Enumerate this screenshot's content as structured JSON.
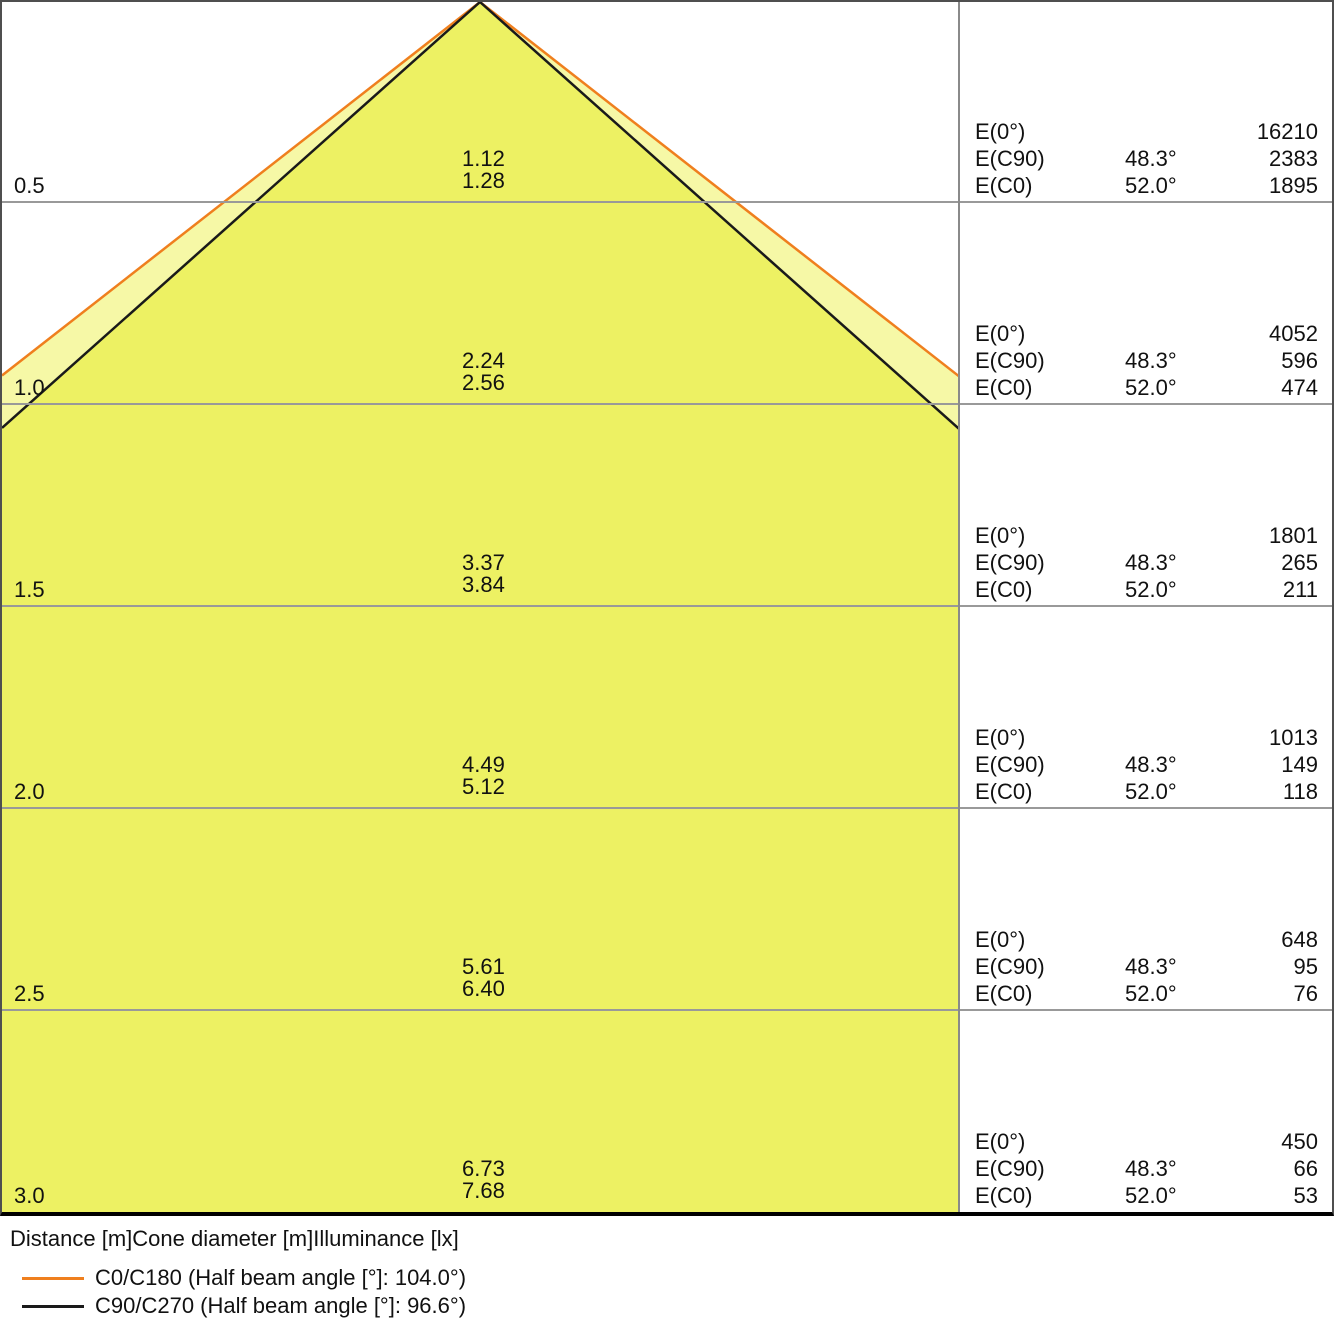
{
  "colors": {
    "cone_outer_fill": "#F6F8A6",
    "cone_inner_fill": "#EDF163",
    "c0_line": "#EF7F1E",
    "c90_line": "#1A1A1A",
    "grid_line": "#999999",
    "frame": "#4F4F4F"
  },
  "panel": {
    "e0_label": "E(0°)",
    "ec90_label": "E(C90)",
    "ec0_label": "E(C0)"
  },
  "rows": [
    {
      "distance": "0.5",
      "cone_c90": "1.12",
      "cone_c0": "1.28",
      "e0": "16210",
      "ec90_angle": "48.3°",
      "ec90": "2383",
      "ec0_angle": "52.0°",
      "ec0": "1895"
    },
    {
      "distance": "1.0",
      "cone_c90": "2.24",
      "cone_c0": "2.56",
      "e0": "4052",
      "ec90_angle": "48.3°",
      "ec90": "596",
      "ec0_angle": "52.0°",
      "ec0": "474"
    },
    {
      "distance": "1.5",
      "cone_c90": "3.37",
      "cone_c0": "3.84",
      "e0": "1801",
      "ec90_angle": "48.3°",
      "ec90": "265",
      "ec0_angle": "52.0°",
      "ec0": "211"
    },
    {
      "distance": "2.0",
      "cone_c90": "4.49",
      "cone_c0": "5.12",
      "e0": "1013",
      "ec90_angle": "48.3°",
      "ec90": "149",
      "ec0_angle": "52.0°",
      "ec0": "118"
    },
    {
      "distance": "2.5",
      "cone_c90": "5.61",
      "cone_c0": "6.40",
      "e0": "648",
      "ec90_angle": "48.3°",
      "ec90": "95",
      "ec0_angle": "52.0°",
      "ec0": "76"
    },
    {
      "distance": "3.0",
      "cone_c90": "6.73",
      "cone_c0": "7.68",
      "e0": "450",
      "ec90_angle": "48.3°",
      "ec90": "66",
      "ec0_angle": "52.0°",
      "ec0": "53"
    }
  ],
  "legend": {
    "columns": "Distance [m]Cone diameter [m]Illuminance [lx]",
    "c0_label": "C0/C180 (Half beam angle [°]: 104.0°)",
    "c90_label": "C90/C270 (Half beam angle [°]: 96.6°)"
  },
  "chart_data": {
    "type": "line",
    "title": "Light cone diagram (illuminance cone)",
    "xlabel": "Distance [m]",
    "x": [
      0.5,
      1.0,
      1.5,
      2.0,
      2.5,
      3.0
    ],
    "grid": "horizontal lines at each 0.5 m",
    "legend_position": "bottom-left",
    "series": [
      {
        "name": "C0/C180 (Half beam angle [°]: 104.0°)",
        "color": "#EF7F1E",
        "half_beam_angle_deg": 104.0,
        "half_angle_deg": 52.0,
        "cone_diameter_m": [
          1.28,
          2.56,
          3.84,
          5.12,
          6.4,
          7.68
        ]
      },
      {
        "name": "C90/C270 (Half beam angle [°]: 96.6°)",
        "color": "#1A1A1A",
        "half_beam_angle_deg": 96.6,
        "half_angle_deg": 48.3,
        "cone_diameter_m": [
          1.12,
          2.24,
          3.37,
          4.49,
          5.61,
          6.73
        ]
      }
    ],
    "illuminance_lx": [
      {
        "distance_m": 0.5,
        "E0": 16210,
        "EC90": 2383,
        "EC0": 1895
      },
      {
        "distance_m": 1.0,
        "E0": 4052,
        "EC90": 596,
        "EC0": 474
      },
      {
        "distance_m": 1.5,
        "E0": 1801,
        "EC90": 265,
        "EC0": 211
      },
      {
        "distance_m": 2.0,
        "E0": 1013,
        "EC90": 149,
        "EC0": 118
      },
      {
        "distance_m": 2.5,
        "E0": 648,
        "EC90": 95,
        "EC0": 76
      },
      {
        "distance_m": 3.0,
        "E0": 450,
        "EC90": 66,
        "EC0": 53
      }
    ],
    "angle_columns": {
      "EC90": "48.3°",
      "EC0": "52.0°"
    }
  }
}
